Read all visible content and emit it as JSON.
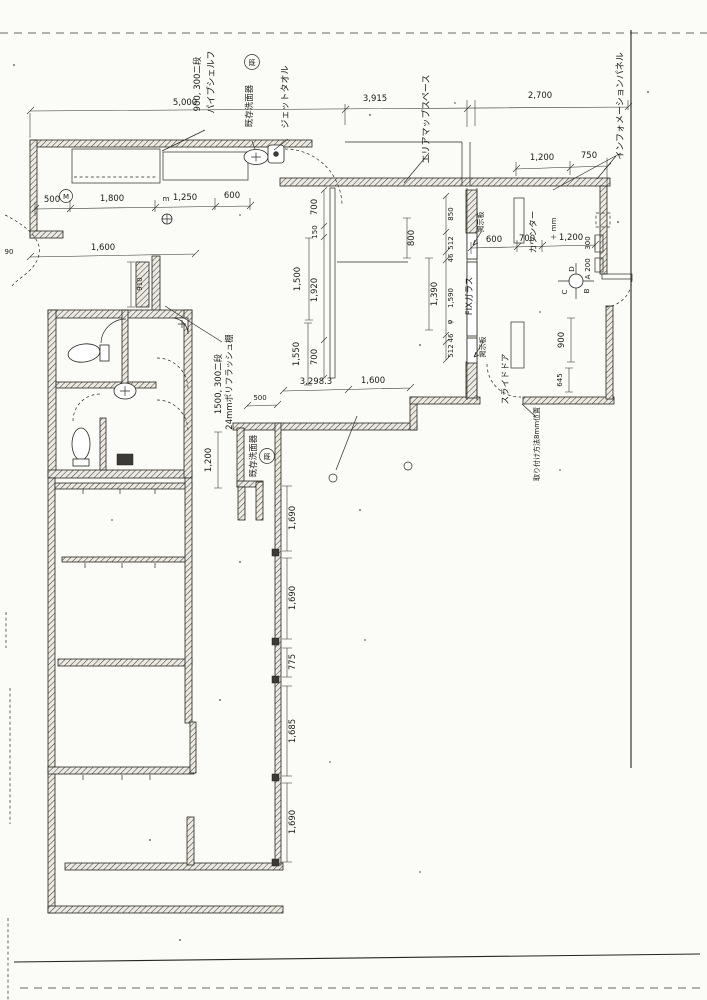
{
  "drawing": {
    "paper_color": "#fbfbf7",
    "line_color": "#26251f",
    "type": "scanned architectural floor plan (Japanese)"
  },
  "labels": [
    {
      "t": "パイプシェルフ"
    },
    {
      "t": "900, 300二段"
    },
    {
      "t": "既"
    },
    {
      "t": "既存洗面器"
    },
    {
      "t": "ジェットタオル"
    },
    {
      "t": "エリアマップスペース"
    },
    {
      "t": "インフォメーションパネル"
    },
    {
      "t": "FIXガラス"
    },
    {
      "t": "掲示板"
    },
    {
      "t": "掲示板"
    },
    {
      "t": "カウンター"
    },
    {
      "t": "スライドドア"
    },
    {
      "t": "取り付け方法8mm位置"
    },
    {
      "t": "24mmポリフラッシュ棚"
    },
    {
      "t": "1500, 300二段"
    },
    {
      "t": "既"
    },
    {
      "t": "既存洗面器"
    },
    {
      "t": "＋ mm"
    },
    {
      "t": "M"
    },
    {
      "t": "m"
    },
    {
      "t": "φ"
    }
  ],
  "compass": {
    "a": "A",
    "b": "B",
    "c": "C",
    "d": "D"
  },
  "dims": [
    {
      "t": "5,000"
    },
    {
      "t": "3,915"
    },
    {
      "t": "2,700"
    },
    {
      "t": "1,200"
    },
    {
      "t": "750"
    },
    {
      "t": "500"
    },
    {
      "t": "1,800"
    },
    {
      "t": "1,250"
    },
    {
      "t": "600"
    },
    {
      "t": "1,600"
    },
    {
      "t": "90"
    },
    {
      "t": "600"
    },
    {
      "t": "700"
    },
    {
      "t": "1,200"
    },
    {
      "t": "3,298.3"
    },
    {
      "t": "1,600"
    },
    {
      "t": "500"
    },
    {
      "t": "700"
    },
    {
      "t": "150"
    },
    {
      "t": "1,920"
    },
    {
      "t": "700"
    },
    {
      "t": "1,500"
    },
    {
      "t": "1,550"
    },
    {
      "t": "800"
    },
    {
      "t": "1,390"
    },
    {
      "t": "850"
    },
    {
      "t": "512"
    },
    {
      "t": "46"
    },
    {
      "t": "1,590"
    },
    {
      "t": "512"
    },
    {
      "t": "46"
    },
    {
      "t": "910"
    },
    {
      "t": "1,200"
    },
    {
      "t": "900"
    },
    {
      "t": "645"
    },
    {
      "t": "300"
    },
    {
      "t": "200"
    },
    {
      "t": "1,690"
    },
    {
      "t": "1,690"
    },
    {
      "t": "775"
    },
    {
      "t": "1,685"
    },
    {
      "t": "1,690"
    }
  ]
}
